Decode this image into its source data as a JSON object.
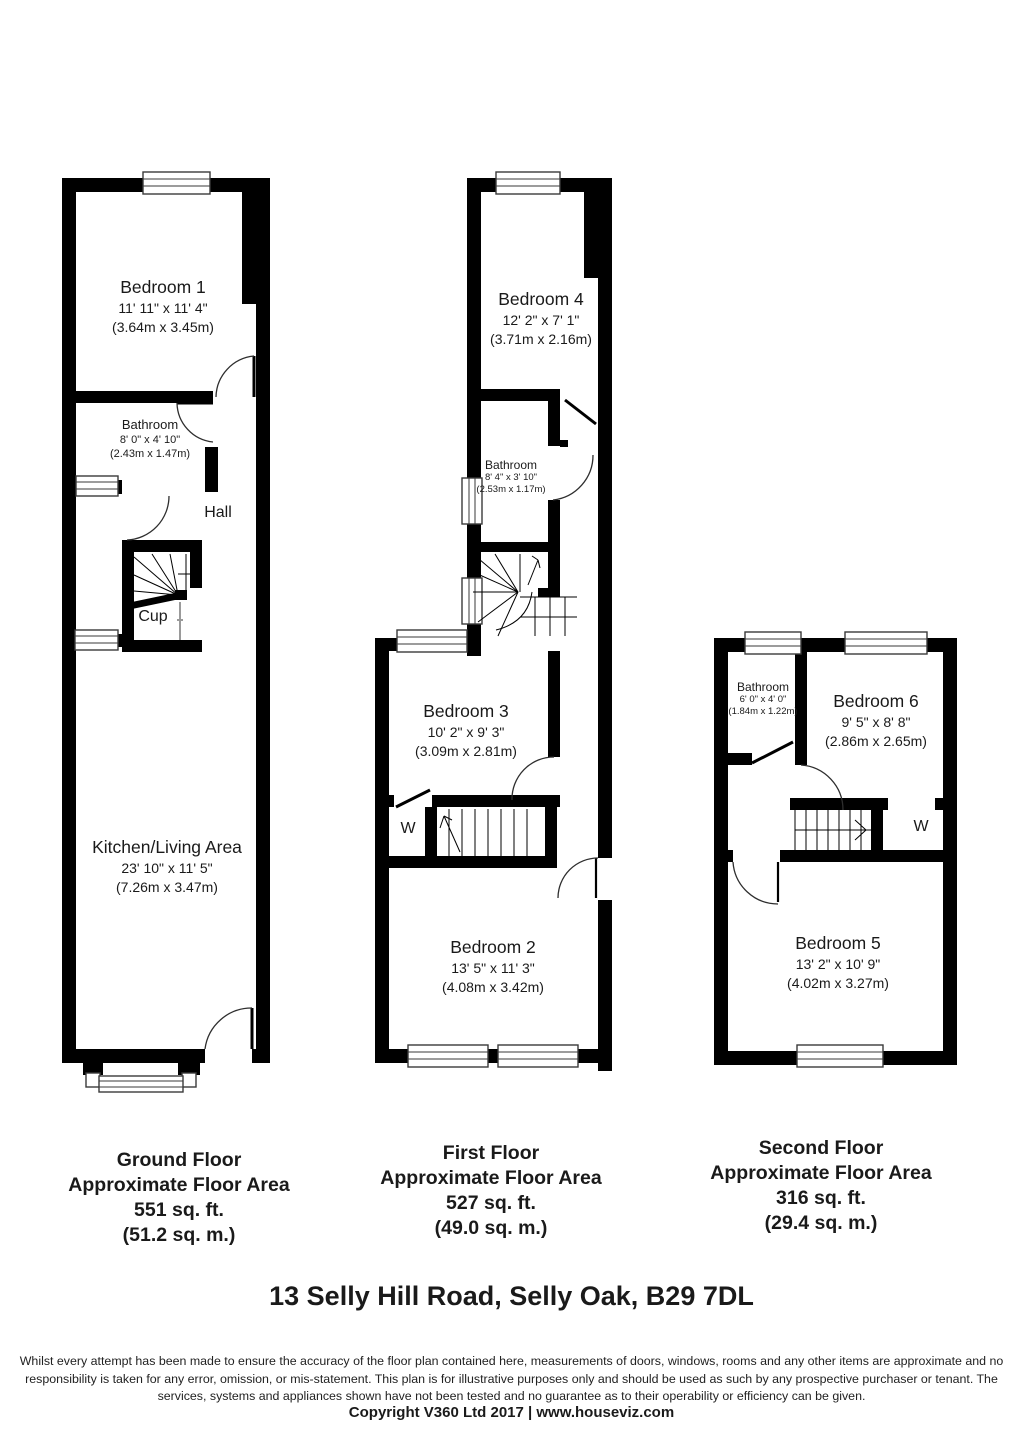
{
  "plans": {
    "ground": {
      "rooms": {
        "bedroom1": {
          "name": "Bedroom 1",
          "imperial": "11' 11\" x 11' 4\"",
          "metric": "(3.64m x 3.45m)"
        },
        "bathroom": {
          "name": "Bathroom",
          "imperial": "8' 0\" x 4' 10\"",
          "metric": "(2.43m x 1.47m)"
        },
        "hall": {
          "name": "Hall"
        },
        "cupboard": {
          "name": "Cup"
        },
        "kitchen": {
          "name": "Kitchen/Living Area",
          "imperial": "23' 10\" x 11' 5\"",
          "metric": "(7.26m x 3.47m)"
        }
      },
      "caption": {
        "title": "Ground Floor",
        "subtitle": "Approximate Floor Area",
        "area_ft": "551 sq. ft.",
        "area_m": "(51.2 sq. m.)"
      }
    },
    "first": {
      "rooms": {
        "bedroom4": {
          "name": "Bedroom 4",
          "imperial": "12' 2\" x 7' 1\"",
          "metric": "(3.71m x 2.16m)"
        },
        "bathroom": {
          "name": "Bathroom",
          "imperial": "8' 4\" x 3' 10\"",
          "metric": "(2.53m x 1.17m)"
        },
        "bedroom3": {
          "name": "Bedroom 3",
          "imperial": "10' 2\" x 9' 3\"",
          "metric": "(3.09m x 2.81m)"
        },
        "wardrobe": {
          "name": "W"
        },
        "bedroom2": {
          "name": "Bedroom 2",
          "imperial": "13' 5\" x 11' 3\"",
          "metric": "(4.08m x 3.42m)"
        }
      },
      "caption": {
        "title": "First Floor",
        "subtitle": "Approximate Floor Area",
        "area_ft": "527 sq. ft.",
        "area_m": "(49.0 sq. m.)"
      }
    },
    "second": {
      "rooms": {
        "bathroom": {
          "name": "Bathroom",
          "imperial": "6' 0\" x 4' 0\"",
          "metric": "(1.84m x 1.22m)"
        },
        "bedroom6": {
          "name": "Bedroom 6",
          "imperial": "9' 5\" x 8' 8\"",
          "metric": "(2.86m x 2.65m)"
        },
        "wardrobe": {
          "name": "W"
        },
        "bedroom5": {
          "name": "Bedroom 5",
          "imperial": "13' 2\" x 10' 9\"",
          "metric": "(4.02m x 3.27m)"
        }
      },
      "caption": {
        "title": "Second Floor",
        "subtitle": "Approximate Floor Area",
        "area_ft": "316 sq. ft.",
        "area_m": "(29.4 sq. m.)"
      }
    }
  },
  "address": "13 Selly Hill Road, Selly Oak, B29 7DL",
  "disclaimer": {
    "line1": "Whilst every attempt has been made to ensure the accuracy of the floor plan contained here, measurements of doors, windows, rooms and any other items are approximate and no",
    "line2": "responsibility is taken for any error, omission, or mis-statement. This plan is for illustrative purposes only and should be used as such by any prospective purchaser or tenant. The",
    "line3": "services, systems and appliances shown have not been tested and no guarantee as to their operability or efficiency can be given."
  },
  "copyright": "Copyright V360 Ltd 2017 | www.houseviz.com",
  "colors": {
    "wall": "#000000",
    "background": "#ffffff",
    "text": "#1a1a1a"
  }
}
